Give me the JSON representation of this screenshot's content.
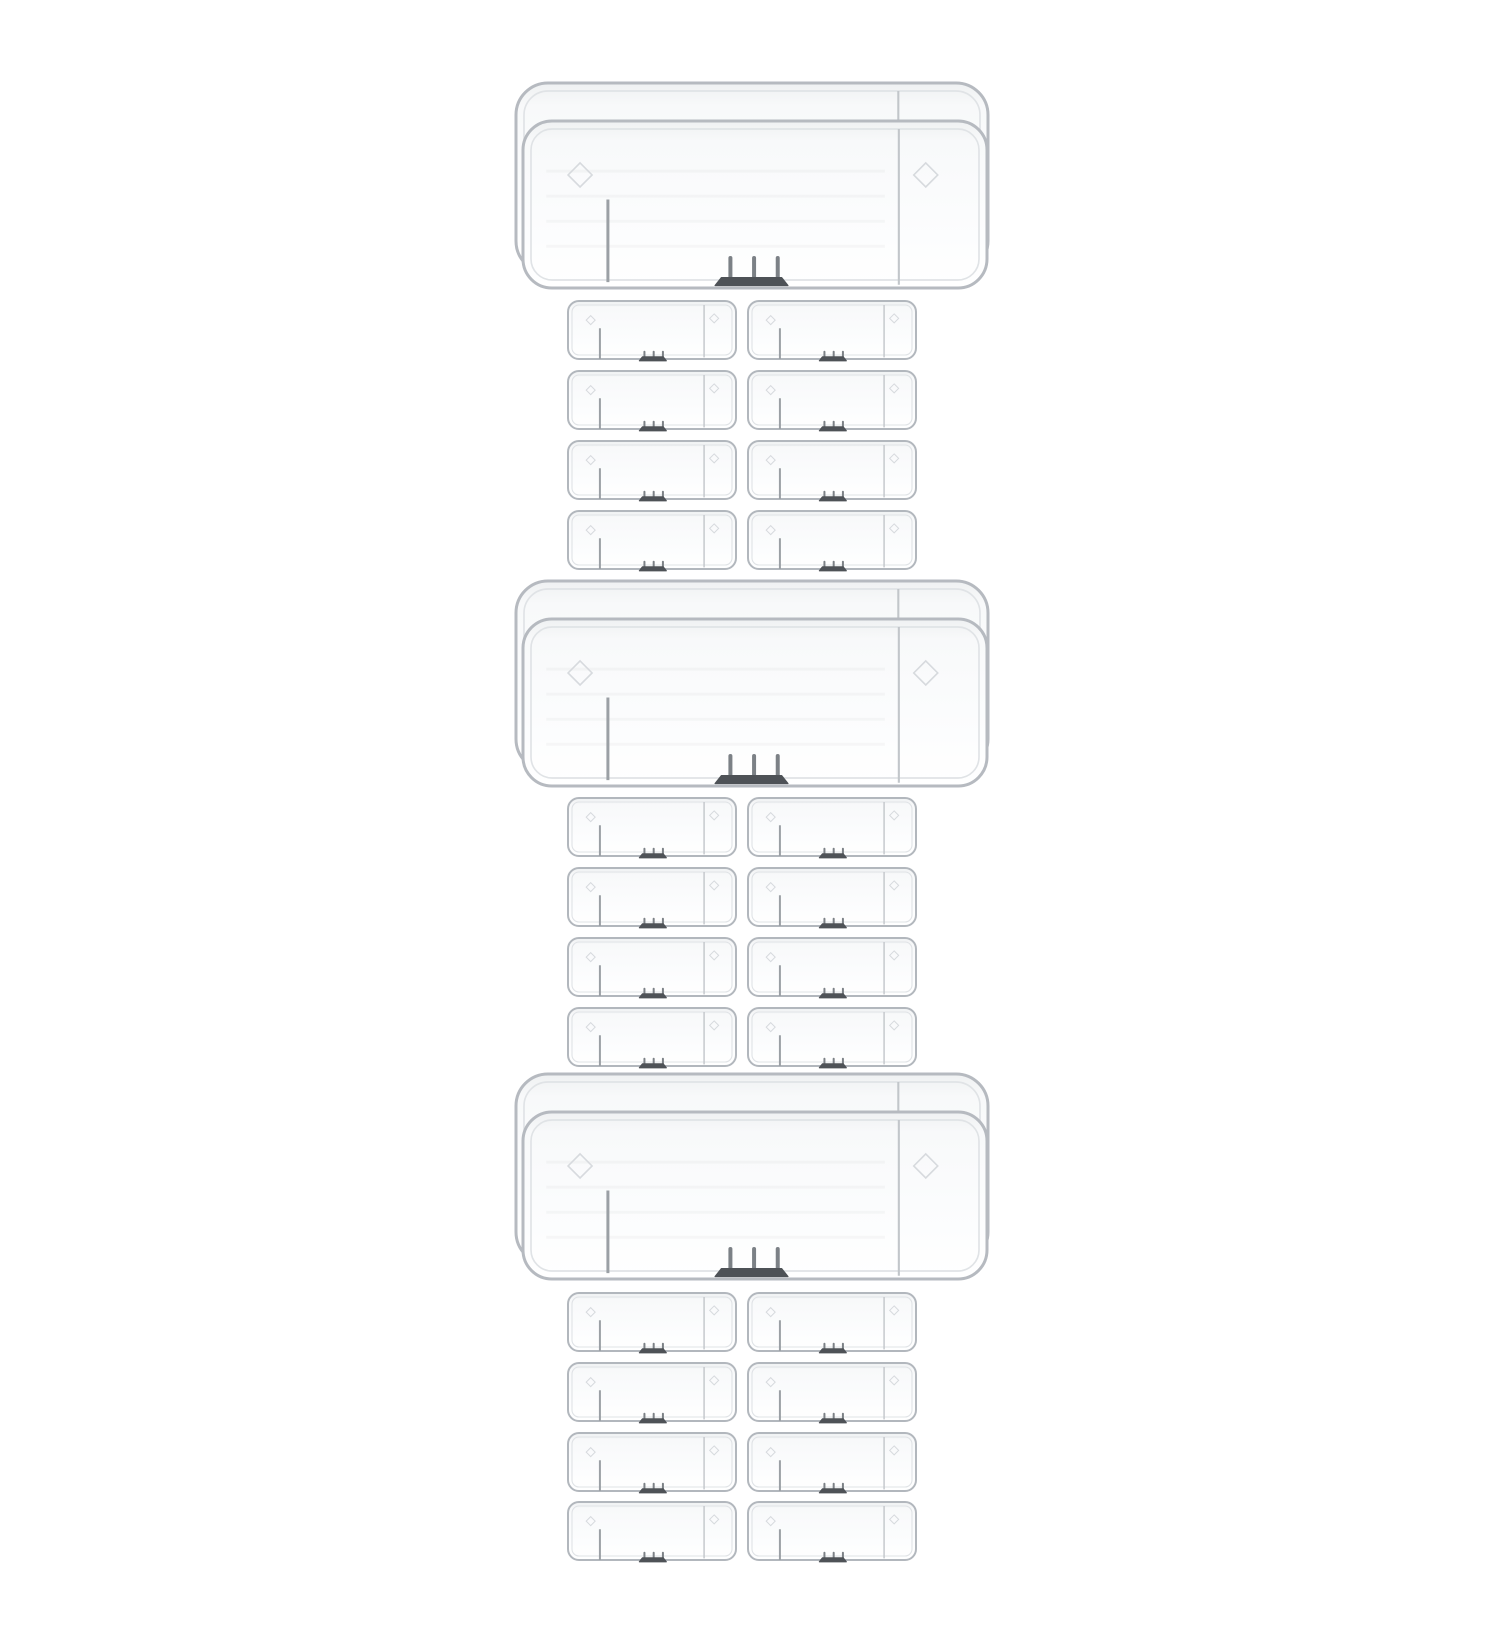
{
  "scene": {
    "description": "Product photo on white background: three sets of clear transparent plastic trays; each set has one large stacked tray pair and eight small trays in a 4 by 2 grid",
    "sets": 3,
    "large_per_set": 1,
    "small_per_set": 8,
    "small_grid": "4 rows x 2 columns",
    "total_small_items": 24
  },
  "colors": {
    "background": "#ffffff",
    "border": "#b6bac0",
    "border_small": "#b2b7bd",
    "rim_inner": "#e0e3e6",
    "divider": "#c2c6ca",
    "vline": "#9ba0a5",
    "tick": "#7c8186",
    "bar_dark": "#4e5257",
    "diamond": "#d7dade",
    "fill_top": "#eff1f2",
    "fill_mid": "#f8f9fa",
    "fill_low": "#fbfcfd",
    "fill_bottom": "#ffffff",
    "streak": "rgba(110,115,120,0.05)"
  },
  "layout": {
    "canvas": {
      "width": 1500,
      "height": 1650
    },
    "large_unit": {
      "w": 464,
      "h": 167,
      "back_dx": -7,
      "back_dy": -38,
      "back_w": 472,
      "back_h": 190,
      "radius": 29,
      "back_radius": 32,
      "stroke": 3,
      "inset": 8,
      "diamond_size": 12,
      "tick_width": 4,
      "vline_width": 3
    },
    "small_unit": {
      "w": 168,
      "h": 58,
      "cols_x": [
        568,
        748
      ],
      "radius": 11,
      "stroke": 2,
      "inset": 4,
      "diamond_size": 4.5,
      "tick_width": 2,
      "vline_width": 2
    },
    "groups": [
      {
        "big_front": {
          "x": 523,
          "y": 121
        },
        "rows_y": [
          301,
          371,
          441,
          511
        ]
      },
      {
        "big_front": {
          "x": 523,
          "y": 619
        },
        "rows_y": [
          798,
          868,
          938,
          1008
        ]
      },
      {
        "big_front": {
          "x": 523,
          "y": 1112
        },
        "rows_y": [
          1293,
          1363,
          1433,
          1502
        ]
      }
    ]
  },
  "features": {
    "large": {
      "divider_x": 0.81,
      "vline_x": 0.183,
      "vline_y1": 0.47,
      "vline_y2": 0.965,
      "diamond_left_x": 0.123,
      "diamond_left_y": 0.323,
      "diamond_right_x": 0.868,
      "diamond_right_y": 0.323,
      "ticks_x": [
        0.447,
        0.498,
        0.549
      ],
      "ticks_y1": 0.82,
      "ticks_y2": 0.935,
      "bar_x1": 0.414,
      "bar_x2": 0.571,
      "bar_y1": 0.938,
      "bar_y2": 0.985,
      "streaks_y": [
        0.3,
        0.45,
        0.6,
        0.75
      ]
    },
    "small": {
      "divider_x": 0.81,
      "vline_x": 0.19,
      "vline_y1": 0.47,
      "vline_y2": 1.0,
      "diamond_left_x": 0.135,
      "diamond_left_y": 0.33,
      "diamond_right_x": 0.87,
      "diamond_right_y": 0.3,
      "ticks_x": [
        0.455,
        0.51,
        0.565
      ],
      "ticks_y1": 0.875,
      "ticks_y2": 0.96,
      "bar_x1": 0.425,
      "bar_x2": 0.585,
      "bar_y1": 0.962,
      "bar_y2": 1.03,
      "streaks_y": []
    }
  }
}
